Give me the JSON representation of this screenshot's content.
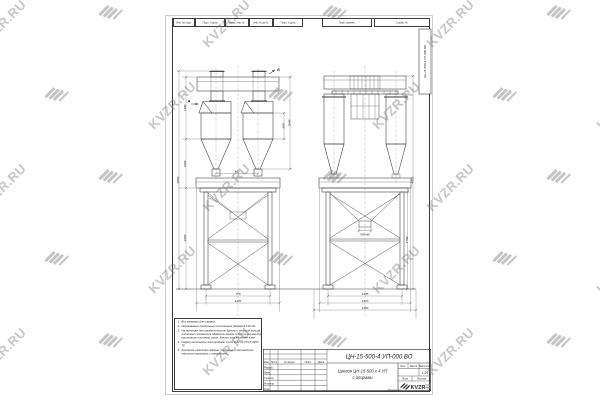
{
  "watermark": {
    "text": "KVZR.RU"
  },
  "sheet": {
    "top_strip": {
      "left_cells": [
        "Инв. № подл.",
        "Подп. и дата",
        "Взам. инв. №",
        "Инв. № дубл.",
        "Подп. и дата"
      ],
      "right_cells": [
        "Перв. примен.",
        "Справ. №"
      ]
    },
    "designation_stamp": "ЦН-15-500-4 УП-000 ВО",
    "views": {
      "front": {
        "section_a": "А",
        "section_b": "Б",
        "dims": {
          "left": [
            "1380",
            "1090",
            "2250"
          ],
          "overall": "4850",
          "right_upper": "580",
          "right_lower": "2040",
          "center": "440",
          "bottom": [
            "770",
            "1170"
          ]
        }
      },
      "side": {
        "dims": {
          "hopper_outlet": "850×60",
          "right": "1750",
          "overall": "4850",
          "bottom": [
            "1285",
            "1470",
            "1580"
          ]
        }
      }
    },
    "notes": {
      "items": [
        {
          "n": "1.",
          "text": "Все размеры для справок."
        },
        {
          "n": "2.",
          "text": "Неуказанные предельные отклонения размеров ±10 мм."
        },
        {
          "n": "3.",
          "text": "На монтаже для герметичности бункер и опорные кольца циклонных элементов обварить между собой по периметру прилегания плотным швом. Катет шва не менее 4 мм."
        },
        {
          "n": "4.",
          "text": "Сварку выполнять электродами типа Э-42 по ГОСТ 9467-75."
        },
        {
          "n": "5.",
          "text": "Контроль качества сварных соединений производить внешним осмотром и измерением."
        }
      ]
    },
    "title_block": {
      "designation": "ЦН-15-500-4 УП-000 ВО",
      "name_line1": "Циклон ЦН-15-500 х 4 УП",
      "name_line2": "с опорами",
      "header_cols": [
        "Изм.",
        "Лист",
        "№ докум.",
        "Подп.",
        "Дата"
      ],
      "sign_rows": [
        "Разраб.",
        "Пров.",
        "Т.контр.",
        "Н.контр.",
        "Утв."
      ],
      "lit_label": "Лит.",
      "mass_label": "Масса",
      "scale_label": "Масштаб",
      "scale_value": "1:25",
      "sheet_label": "Лист",
      "sheets_label": "Листов",
      "logo_text": "KVZR",
      "format_label": "Формат А3"
    }
  }
}
